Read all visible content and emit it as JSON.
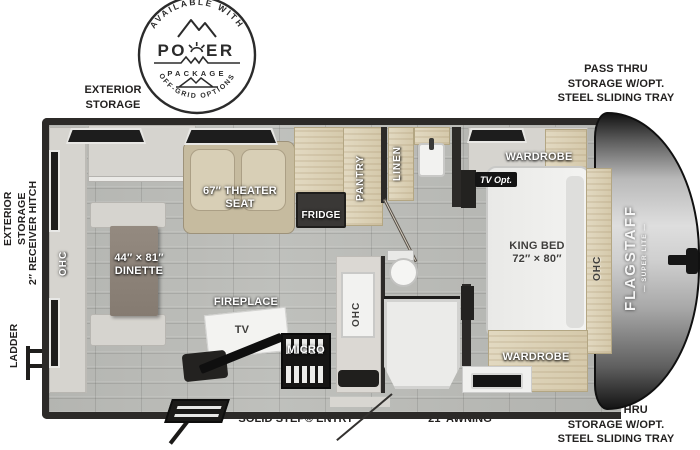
{
  "badge": {
    "arc_top": "AVAILABLE WITH",
    "title_left": "PO",
    "title_right": "ER",
    "subtitle": "PACKAGE",
    "arc_bottom": "OFF-GRID OPTIONS"
  },
  "exterior": {
    "top_left_line1": "EXTERIOR",
    "top_left_line2": "STORAGE",
    "top_right_line1": "PASS THRU",
    "top_right_line2": "STORAGE W/OPT.",
    "top_right_line3": "STEEL SLIDING TRAY",
    "bottom_right_line1": "PASS THRU",
    "bottom_right_line2": "STORAGE W/OPT.",
    "bottom_right_line3": "STEEL SLIDING TRAY",
    "left_line1": "EXTERIOR",
    "left_line2": "STORAGE",
    "hitch": "2″ RECEIVER HITCH",
    "ladder": "LADDER",
    "step": "SOLID STEP® ENTRY",
    "awning": "21′ AWNING"
  },
  "interior": {
    "ohc_rear": "OHC",
    "dinette_line1": "44″ × 81″",
    "dinette_line2": "DINETTE",
    "theater_line1": "67″ THEATER",
    "theater_line2": "SEAT",
    "fridge": "FRIDGE",
    "pantry": "PANTRY",
    "linen": "LINEN",
    "fireplace": "FIREPLACE",
    "tv": "TV",
    "micro": "MICRO",
    "ohc_kitchen": "OHC",
    "tv_opt": "TV Opt.",
    "wardrobe_front": "WARDROBE",
    "wardrobe_rear": "WARDROBE",
    "bed_line1": "KING BED",
    "bed_line2": "72″ × 80″",
    "ohc_front": "OHC"
  },
  "brand": {
    "name": "FLAGSTAFF",
    "sub": "— SUPER LITE —"
  },
  "colors": {
    "wall": "#2c2a28",
    "floor": "#b7b8b4",
    "wood": "#ddd3ba",
    "seat_tan": "#cfc5ab",
    "label_outside": "#232120"
  }
}
